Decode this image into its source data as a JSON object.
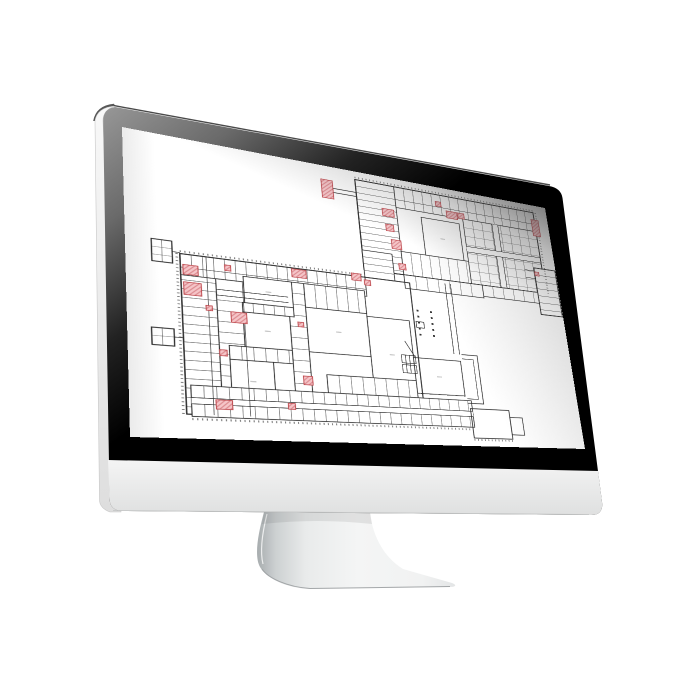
{
  "scene": {
    "description": "desktop-monitor-mockup-with-floor-plan",
    "background": "#ffffff"
  },
  "monitor": {
    "bezel_gradient": [
      "#969696",
      "#6a6a6a",
      "#222222",
      "#000000"
    ],
    "side_top": "#f8f8f8",
    "side_bottom": "#e0e0e0",
    "chin_top": "#f4f4f4",
    "chin_bottom": "#dfe0e0",
    "stand_shade": "#a9aeb0",
    "stand_light": "#f4f5f5",
    "screen_background": "#ffffff",
    "outer_hairline": "#4a4a4a"
  },
  "floor_plan": {
    "canvas": {
      "width": 423,
      "height": 310,
      "background": "#ffffff"
    },
    "wall_color": "#2b2b2b",
    "room_line_color": "#4a4a4a",
    "tick_color": "#555555",
    "label_color": "#c4c4c4",
    "highlight": {
      "fill": "#f5c5c8",
      "hatch": "#dd8d92",
      "border": "#bf4a4f"
    },
    "blocks": [
      {
        "kind": "rooms-h",
        "x": 205,
        "y": 10,
        "w": 40,
        "h": 108,
        "step": 8
      },
      {
        "kind": "rooms-v",
        "x": 245,
        "y": 10,
        "w": 161,
        "h": 26,
        "step": 10
      },
      {
        "kind": "grid",
        "x": 318,
        "y": 36,
        "w": 88,
        "h": 82,
        "step": 11
      },
      {
        "kind": "corridor-v",
        "x": 352,
        "y": 36,
        "w": 7,
        "h": 82
      },
      {
        "kind": "corridor-h",
        "x": 318,
        "y": 71,
        "w": 88,
        "h": 7
      },
      {
        "kind": "rooms-v",
        "x": 245,
        "y": 90,
        "w": 73,
        "h": 28,
        "step": 10
      },
      {
        "kind": "court",
        "x": 271,
        "y": 43,
        "w": 42,
        "h": 47
      },
      {
        "kind": "outline",
        "x": 205,
        "y": 10,
        "w": 201,
        "h": 108,
        "sw": 1.2
      },
      {
        "kind": "rooms-v",
        "x": 330,
        "y": 118,
        "w": 76,
        "h": 14,
        "step": 12
      },
      {
        "kind": "outline",
        "x": 396,
        "y": 86,
        "w": 26,
        "h": 60,
        "sw": 1.5
      },
      {
        "kind": "rooms-h",
        "x": 396,
        "y": 86,
        "w": 26,
        "h": 60,
        "step": 9
      },
      {
        "kind": "rooms-h",
        "x": 205,
        "y": 95,
        "w": 30,
        "h": 32,
        "step": 8
      },
      {
        "kind": "rooms-v",
        "x": 245,
        "y": 118,
        "w": 85,
        "h": 16,
        "step": 12
      },
      {
        "kind": "rooms-h",
        "x": 42,
        "y": 127,
        "w": 28,
        "h": 160,
        "step": 9
      },
      {
        "kind": "rooms-v",
        "x": 42,
        "y": 127,
        "w": 163,
        "h": 22,
        "step": 9
      },
      {
        "kind": "rooms-h",
        "x": 70,
        "y": 149,
        "w": 30,
        "h": 138,
        "step": 11
      },
      {
        "kind": "rooms-h",
        "x": 131,
        "y": 143,
        "w": 15,
        "h": 144,
        "step": 12
      },
      {
        "kind": "rooms-v",
        "x": 146,
        "y": 143,
        "w": 57,
        "h": 26,
        "step": 10
      },
      {
        "kind": "court",
        "x": 93,
        "y": 143,
        "w": 42,
        "h": 28
      },
      {
        "kind": "rooms-v",
        "x": 91,
        "y": 171,
        "w": 44,
        "h": 10,
        "step": 9
      },
      {
        "kind": "court",
        "x": 91,
        "y": 181,
        "w": 40,
        "h": 36
      },
      {
        "kind": "rooms-v",
        "x": 78,
        "y": 217,
        "w": 53,
        "h": 14,
        "step": 10
      },
      {
        "kind": "court",
        "x": 78,
        "y": 231,
        "w": 36,
        "h": 42
      },
      {
        "kind": "court",
        "x": 146,
        "y": 169,
        "w": 57,
        "h": 48
      },
      {
        "kind": "court",
        "x": 203,
        "y": 172,
        "w": 42,
        "h": 82
      },
      {
        "kind": "court",
        "x": 245,
        "y": 214,
        "w": 49,
        "h": 40
      },
      {
        "kind": "rooms-v",
        "x": 160,
        "y": 240,
        "w": 85,
        "h": 19,
        "step": 11
      },
      {
        "kind": "outline",
        "x": 42,
        "y": 127,
        "w": 208,
        "h": 160,
        "sw": 1.1
      },
      {
        "kind": "rooms-v",
        "x": 46,
        "y": 259,
        "w": 254,
        "h": 30,
        "step": 10
      },
      {
        "kind": "corridor-h",
        "x": 46,
        "y": 271,
        "w": 254,
        "h": 6
      },
      {
        "kind": "outline",
        "x": 298,
        "y": 268,
        "w": 42,
        "h": 33,
        "sw": 0.9
      },
      {
        "kind": "outline",
        "x": 340,
        "y": 276,
        "w": 14,
        "h": 20,
        "sw": 0.8
      },
      {
        "kind": "grid",
        "x": 20,
        "y": 115,
        "w": 16,
        "h": 23,
        "step": 8
      },
      {
        "kind": "outline",
        "x": 20,
        "y": 115,
        "w": 16,
        "h": 23,
        "sw": 0.9
      },
      {
        "kind": "grid",
        "x": 18,
        "y": 205,
        "w": 17,
        "h": 17,
        "step": 8
      },
      {
        "kind": "outline",
        "x": 18,
        "y": 205,
        "w": 17,
        "h": 17,
        "sw": 0.9
      },
      {
        "kind": "outline",
        "x": 252,
        "y": 172,
        "w": 8,
        "h": 7,
        "sw": 0.7
      }
    ],
    "paths": [
      {
        "d": "M245,26 H406",
        "sw": 0.5
      },
      {
        "d": "M42,141 H205",
        "sw": 0.5
      },
      {
        "d": "M63,127 V287",
        "sw": 0.5
      },
      {
        "d": "M92,149 V287",
        "sw": 0.5
      },
      {
        "d": "M70,160 H131 M70,166 H131",
        "sw": 0.6
      },
      {
        "d": "M288,122 V206 M294,122 V206",
        "sw": 0.7
      },
      {
        "d": "M296,206 H313 V262 H296",
        "sw": 0.8
      },
      {
        "d": "M296,211 H308 V257 H296",
        "sw": 0.6
      },
      {
        "d": "M233,212 h14 v9 h-14 z M233,223 h14 v9 h-14 z M237,212 v20 M241,212 v20 M245,212 v20",
        "sw": 0.6
      },
      {
        "d": "M238,196 L247,214",
        "sw": 0.7
      },
      {
        "d": "M182,26 H205 M182,31 H205",
        "sw": 0.8
      },
      {
        "d": "M384,90 H396 M384,100 H396",
        "sw": 0.7
      },
      {
        "d": "M36,126 H42",
        "sw": 0.7
      },
      {
        "d": "M35,213 H42",
        "sw": 0.7
      }
    ],
    "ticks": [
      {
        "d": "M205,7.5 H406"
      },
      {
        "d": "M409,10 V118"
      },
      {
        "d": "M39.5,127 V287"
      },
      {
        "d": "M46,291.5 H300"
      },
      {
        "d": "M298,303 H340"
      },
      {
        "d": "M42,124.5 H205"
      }
    ],
    "dots": {
      "size": 2,
      "cols": [
        {
          "x": 255,
          "y0": 158,
          "y1": 192,
          "step": 7
        },
        {
          "x": 269,
          "y0": 158,
          "y1": 192,
          "step": 7
        }
      ]
    },
    "highlights": [
      {
        "x": 171,
        "y": 17,
        "w": 11,
        "h": 22
      },
      {
        "x": 402,
        "y": 20,
        "w": 9,
        "h": 22
      },
      {
        "x": 289,
        "y": 19,
        "w": 6,
        "h": 6
      },
      {
        "x": 300,
        "y": 29,
        "w": 12,
        "h": 9
      },
      {
        "x": 313,
        "y": 29,
        "w": 7,
        "h": 7
      },
      {
        "x": 230,
        "y": 40,
        "w": 12,
        "h": 9
      },
      {
        "x": 232,
        "y": 59,
        "w": 8,
        "h": 8
      },
      {
        "x": 236,
        "y": 77,
        "w": 10,
        "h": 11
      },
      {
        "x": 241,
        "y": 105,
        "w": 7,
        "h": 7
      },
      {
        "x": 192,
        "y": 124,
        "w": 9,
        "h": 8
      },
      {
        "x": 204,
        "y": 130,
        "w": 6,
        "h": 6
      },
      {
        "x": 44,
        "y": 138,
        "w": 12,
        "h": 10
      },
      {
        "x": 44,
        "y": 156,
        "w": 14,
        "h": 13
      },
      {
        "x": 78,
        "y": 133,
        "w": 5,
        "h": 6
      },
      {
        "x": 136,
        "y": 128,
        "w": 13,
        "h": 9
      },
      {
        "x": 61,
        "y": 178,
        "w": 5,
        "h": 5
      },
      {
        "x": 81,
        "y": 182,
        "w": 13,
        "h": 11
      },
      {
        "x": 138,
        "y": 186,
        "w": 5,
        "h": 5
      },
      {
        "x": 70,
        "y": 222,
        "w": 6,
        "h": 6
      },
      {
        "x": 139,
        "y": 243,
        "w": 8,
        "h": 9
      },
      {
        "x": 65,
        "y": 272,
        "w": 13,
        "h": 9
      },
      {
        "x": 124,
        "y": 272,
        "w": 6,
        "h": 6
      },
      {
        "x": 396,
        "y": 91,
        "w": 5,
        "h": 5
      }
    ]
  }
}
